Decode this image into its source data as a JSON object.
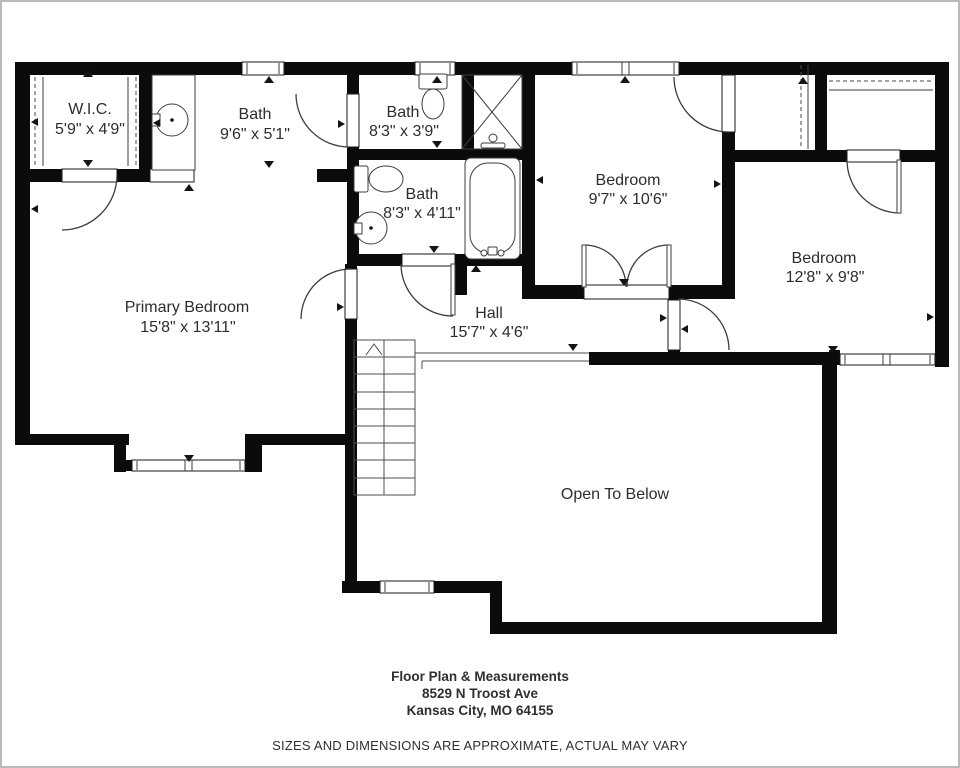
{
  "plan": {
    "rooms": {
      "wic": {
        "name": "W.I.C.",
        "dims": "5'9\" x 4'9\""
      },
      "bath_primary": {
        "name": "Bath",
        "dims": "9'6\" x 5'1\""
      },
      "bath_upper": {
        "name": "Bath",
        "dims": "8'3\" x 3'9\""
      },
      "bath_hall": {
        "name": "Bath",
        "dims": "8'3\" x 4'11\""
      },
      "bedroom_1": {
        "name": "Bedroom",
        "dims": "9'7\" x 10'6\""
      },
      "bedroom_2": {
        "name": "Bedroom",
        "dims": "12'8\" x 9'8\""
      },
      "primary_bedroom": {
        "name": "Primary Bedroom",
        "dims": "15'8\" x 13'11\""
      },
      "hall": {
        "name": "Hall",
        "dims": "15'7\" x 4'6\""
      },
      "open_to_below": {
        "name": "Open To Below"
      }
    }
  },
  "footer": {
    "title": "Floor Plan & Measurements",
    "address_line1": "8529 N Troost Ave",
    "address_line2": "Kansas City, MO 64155",
    "disclaimer": "SIZES AND DIMENSIONS ARE APPROXIMATE, ACTUAL MAY VARY"
  },
  "colors": {
    "wall": "#0b0b0b",
    "line": "#3d3d3d",
    "text": "#2d2d2d",
    "background": "#ffffff",
    "frame": "#b9b9b9"
  }
}
